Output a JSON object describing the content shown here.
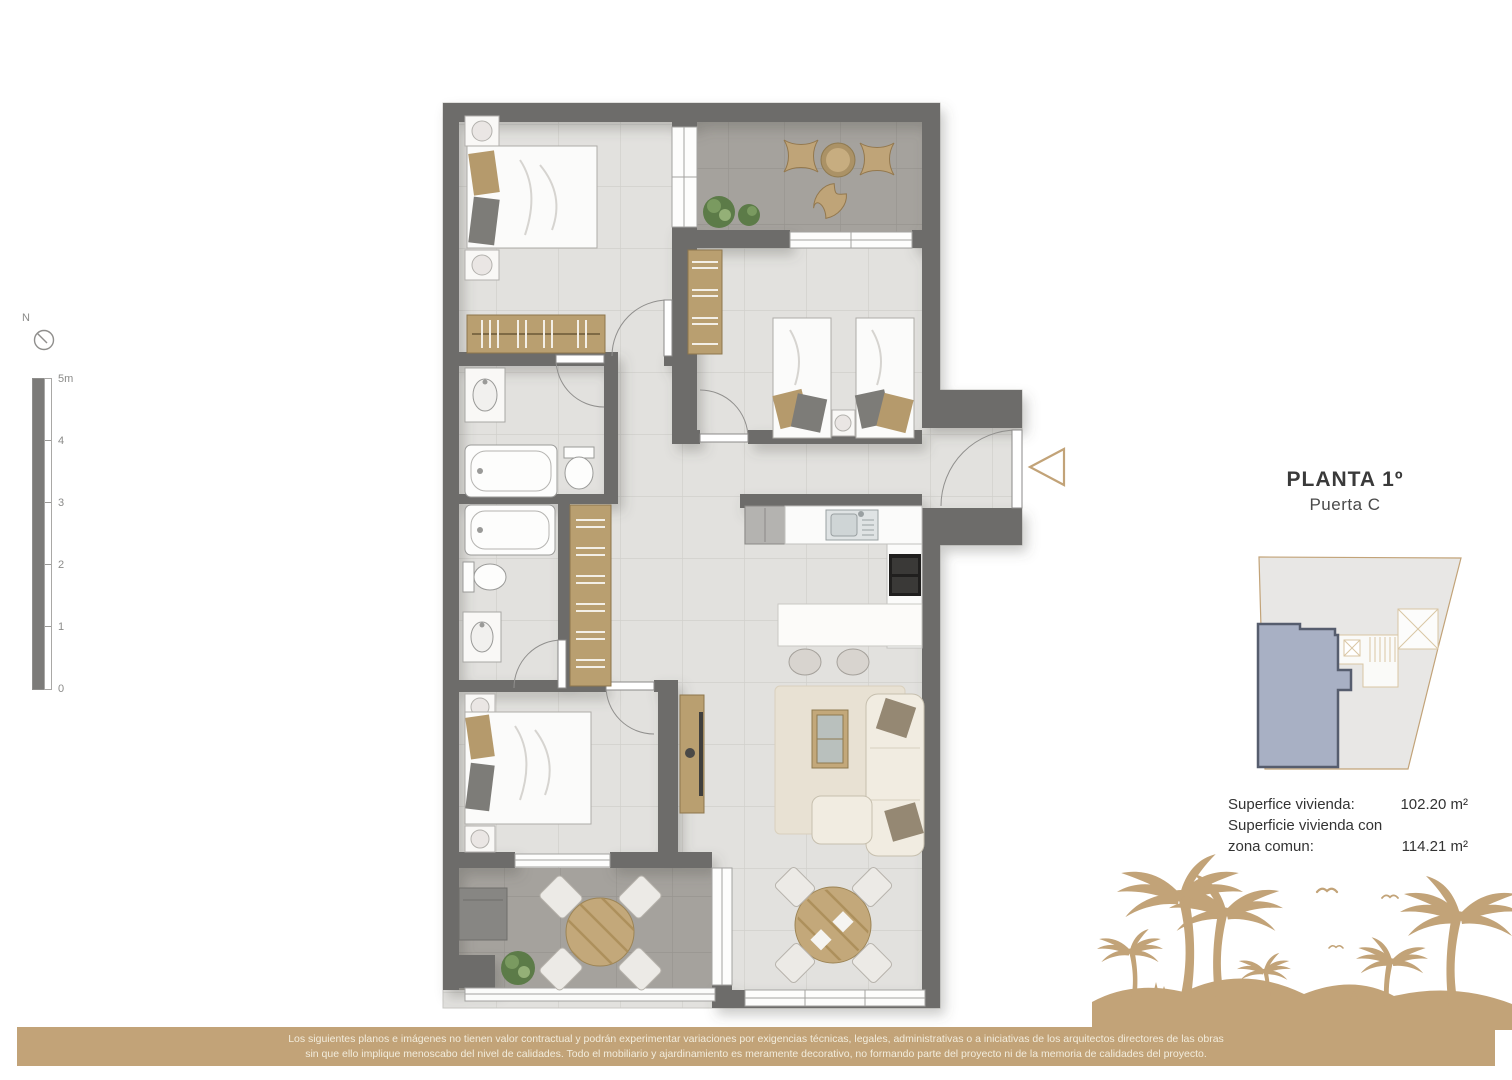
{
  "compass": {
    "north_label": "N"
  },
  "scalebar": {
    "labels": [
      "5m",
      "4",
      "3",
      "2",
      "1",
      "0"
    ]
  },
  "panel": {
    "title": "PLANTA 1º",
    "subtitle": "Puerta C",
    "areas": [
      {
        "label": "Superfice vivienda:",
        "value": "102.20 m²"
      },
      {
        "label": "Superficie vivienda con",
        "value": ""
      },
      {
        "label": "zona comun:",
        "value": "114.21 m²"
      }
    ]
  },
  "footer": {
    "line1": "Los siguientes planos e imágenes no tienen valor contractual y podrán experimentar variaciones por exigencias técnicas, legales, administrativas o a iniciativas de los arquitectos directores de las obras",
    "line2": "sin que ello implique menoscabo del nivel de calidades. Todo el mobiliario y ajardinamiento es meramente decorativo, no formando parte del proyecto ni de la memoria de calidades del proyecto."
  },
  "colors": {
    "accent_tan": "#c2a378",
    "wall_gray": "#6d6c6a",
    "floor_light": "#e2e1de",
    "floor_terrace": "#a5a29d",
    "unit_highlight": "#a8b0c4",
    "unit_border": "#565d6e"
  }
}
